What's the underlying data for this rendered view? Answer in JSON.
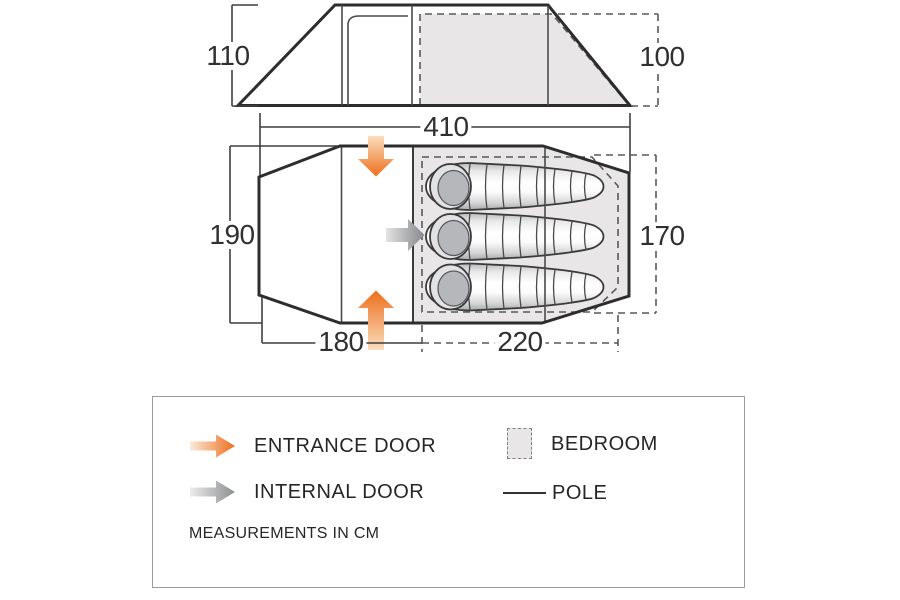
{
  "dimensions": {
    "side_height_left": "110",
    "side_height_right": "100",
    "total_length": "410",
    "plan_width_left": "190",
    "plan_width_right": "170",
    "porch_length": "180",
    "bedroom_length": "220"
  },
  "floor_plan": {
    "sleeping_bag_count": 3
  },
  "legend": {
    "entrance_door_label": "ENTRANCE DOOR",
    "internal_door_label": "INTERNAL DOOR",
    "bedroom_label": "BEDROOM",
    "pole_label": "POLE",
    "note": "MEASUREMENTS IN CM"
  },
  "colors": {
    "accent_orange": "#ed7623",
    "arrow_gray": "#8b8e91",
    "bedroom_fill": "#e9e6e7",
    "outline_dark": "#2d2d2d",
    "dash_gray": "#58595b"
  }
}
